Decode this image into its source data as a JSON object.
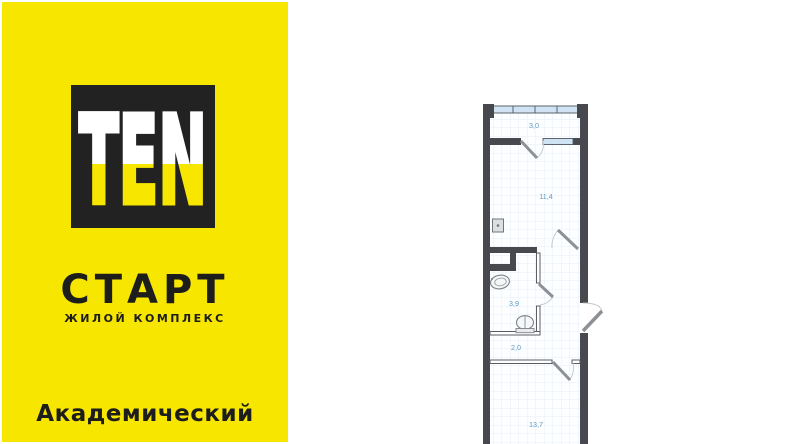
{
  "banner": {
    "logo_text": "TEN",
    "project_name": "СТАРТ",
    "project_subtitle": "ЖИЛОЙ КОМПЛЕКС",
    "location": "Академический",
    "brand_yellow": "#F7E600",
    "brand_black": "#1D1D1B"
  },
  "floor_plan": {
    "type": "apartment-studio-plan",
    "rooms": [
      {
        "name": "loggia",
        "area": "3,0"
      },
      {
        "name": "room",
        "area": "11,4"
      },
      {
        "name": "bathroom",
        "area": "3,9"
      },
      {
        "name": "hallway",
        "area": "2,0"
      },
      {
        "name": "room-main",
        "area": "13,7"
      }
    ],
    "area_label_color": "#5E9DC8",
    "wall_color": "#47494E",
    "window_fill": "#CFE3F5",
    "fixtures": [
      "electrical-panel",
      "sink",
      "toilet"
    ],
    "doors": [
      "loggia-door",
      "room-door",
      "bathroom-door",
      "hallway-door",
      "entrance-door"
    ]
  }
}
